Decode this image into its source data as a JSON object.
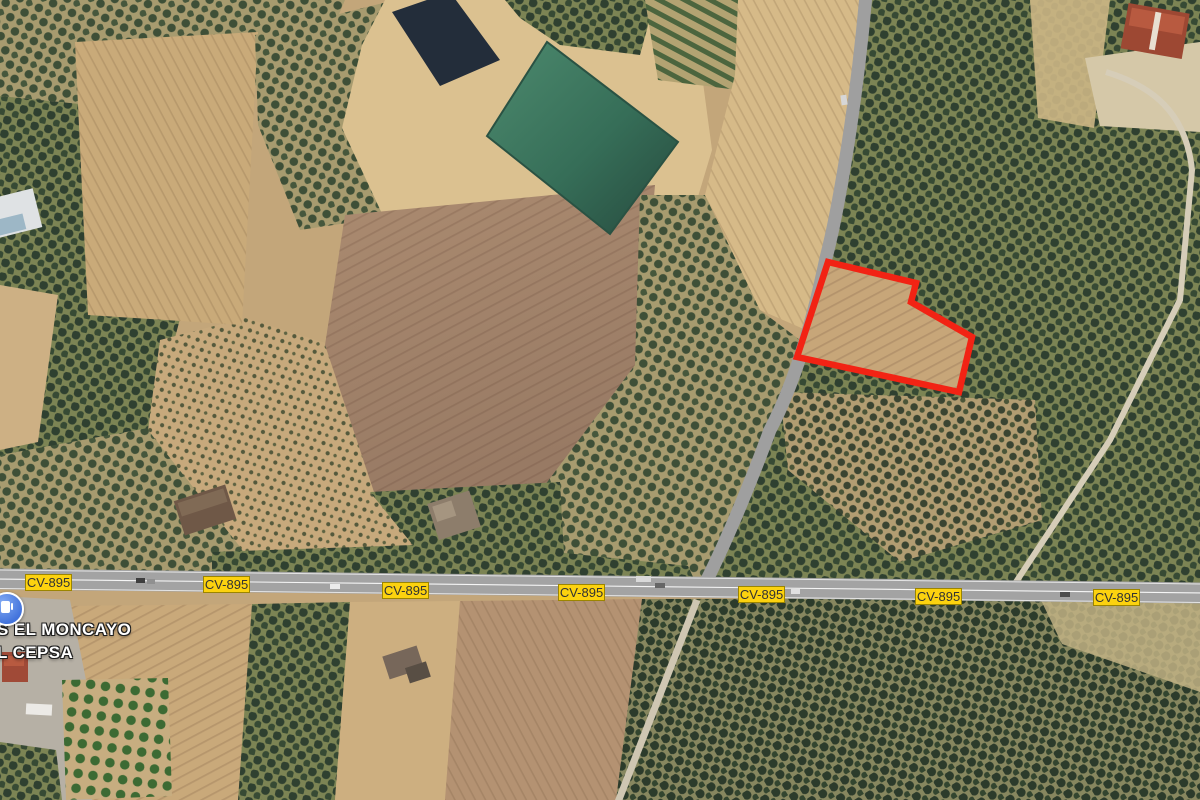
{
  "map": {
    "view": "satellite",
    "road": {
      "ref": "CV-895",
      "label_positions": [
        [
          25,
          574
        ],
        [
          203,
          576
        ],
        [
          382,
          582
        ],
        [
          558,
          584
        ],
        [
          738,
          586
        ],
        [
          915,
          588
        ],
        [
          1093,
          589
        ]
      ]
    },
    "place_labels": [
      {
        "text": "S EL MONCAYO",
        "x": -3,
        "y": 620
      },
      {
        "text": "L CEPSA",
        "x": -3,
        "y": 643
      }
    ],
    "poi": {
      "name": "gas-station",
      "x": -10,
      "y": 592
    },
    "parcel": {
      "stroke": "#f22314",
      "stroke_width": 6.5,
      "points": [
        [
          828,
          262
        ],
        [
          916,
          283
        ],
        [
          911,
          302
        ],
        [
          972,
          337
        ],
        [
          959,
          392
        ],
        [
          797,
          357
        ]
      ]
    },
    "colors": {
      "badge_bg": "#fcd20f",
      "badge_border": "#9c8500",
      "badge_text": "#333333",
      "road_gray": "#a3a3a3",
      "water_green": "#3d7561",
      "water_dark": "#232d3a",
      "parcel_red": "#f22314"
    }
  }
}
